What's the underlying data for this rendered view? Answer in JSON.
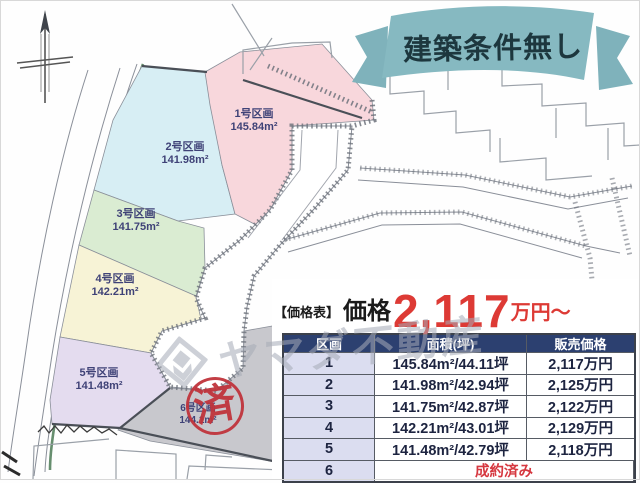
{
  "banner": {
    "label": "建築条件無し"
  },
  "watermark": {
    "text": "ヤマダ不動産"
  },
  "price_header": {
    "prefix": "【価格表】",
    "label": "価格",
    "amount": "2,117",
    "suffix": "万円〜"
  },
  "table": {
    "headers": {
      "lot": "区画",
      "area": "面積(坪)",
      "price": "販売価格"
    },
    "rows": [
      {
        "no": "1",
        "area": "145.84m²/44.11坪",
        "price": "2,117万円"
      },
      {
        "no": "2",
        "area": "141.98m²/42.94坪",
        "price": "2,125万円"
      },
      {
        "no": "3",
        "area": "141.75m²/42.87坪",
        "price": "2,122万円"
      },
      {
        "no": "4",
        "area": "142.21m²/43.01坪",
        "price": "2,129万円"
      },
      {
        "no": "5",
        "area": "141.48m²/42.79坪",
        "price": "2,118万円"
      },
      {
        "no": "6",
        "status": "成約済み"
      }
    ]
  },
  "map": {
    "plots": [
      {
        "label": "1号区画",
        "area": "145.84m²",
        "color": "#f8d7dc"
      },
      {
        "label": "2号区画",
        "area": "141.98m²",
        "color": "#d7eef4"
      },
      {
        "label": "3号区画",
        "area": "141.75m²",
        "color": "#daecd2"
      },
      {
        "label": "4号区画",
        "area": "142.21m²",
        "color": "#f7f3d6"
      },
      {
        "label": "5号区画",
        "area": "141.48m²",
        "color": "#e4dcef"
      },
      {
        "label": "6号区画",
        "area": "144.1m²",
        "color": "#c8c8cd"
      }
    ],
    "stamp": "済"
  },
  "colors": {
    "ribbon_teal": "#86b9c1",
    "header_navy": "#2c4070",
    "price_red": "#dd3a35",
    "sold_red": "#d63840",
    "lot_column_lavender": "#dbddf0"
  }
}
